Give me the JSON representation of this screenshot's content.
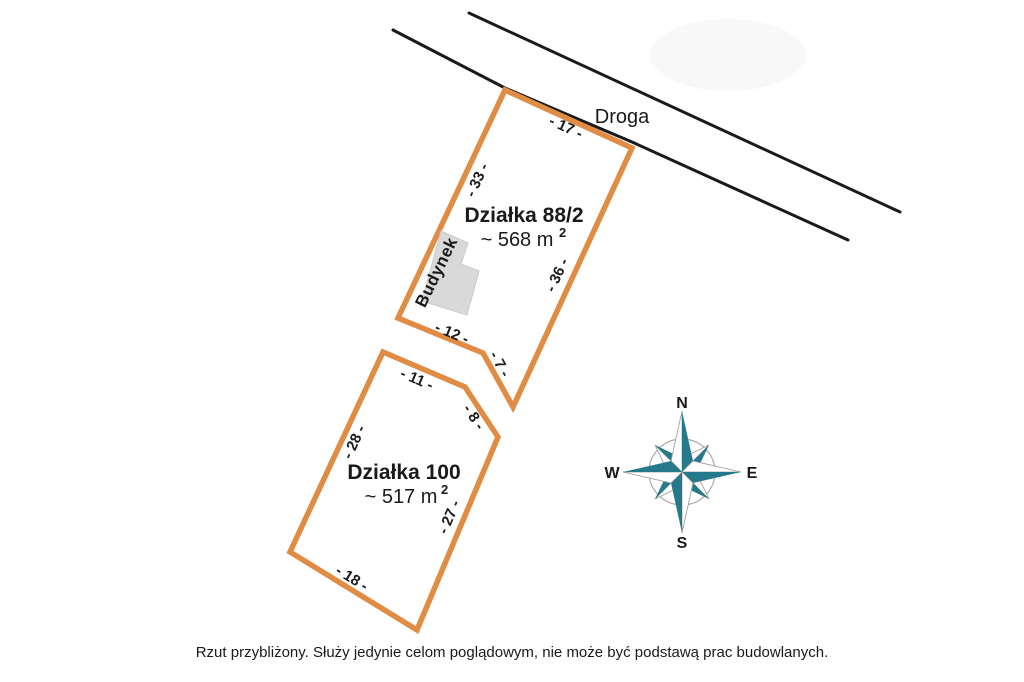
{
  "road": {
    "label": "Droga"
  },
  "parcels": [
    {
      "name": "Działka 88/2",
      "area": "~ 568 m",
      "area_exponent": "2",
      "dimensions": {
        "top": "- 17 -",
        "left": "- 33 -",
        "right": "- 36 -",
        "bottom": "- 12 -",
        "notch": "- 7 -"
      }
    },
    {
      "name": "Działka 100",
      "area": "~ 517 m",
      "area_exponent": "2",
      "dimensions": {
        "top": "- 11 -",
        "upper_right": "- 8 -",
        "left": "- 28 -",
        "right": "- 27 -",
        "bottom": "- 18 -"
      }
    }
  ],
  "building": {
    "label": "Budynek"
  },
  "compass": {
    "north": "N",
    "east": "E",
    "south": "S",
    "west": "W"
  },
  "footer": {
    "disclaimer": "Rzut przybliżony. Służy jedynie celom poglądowym, nie może być podstawą prac budowlanych."
  },
  "colors": {
    "parcel_outline": "#E08C45",
    "parcel_fill": "#FFFFFF",
    "building_fill": "#D9D9D9",
    "compass_teal": "#26798A",
    "line_black": "#1A1A1A"
  }
}
